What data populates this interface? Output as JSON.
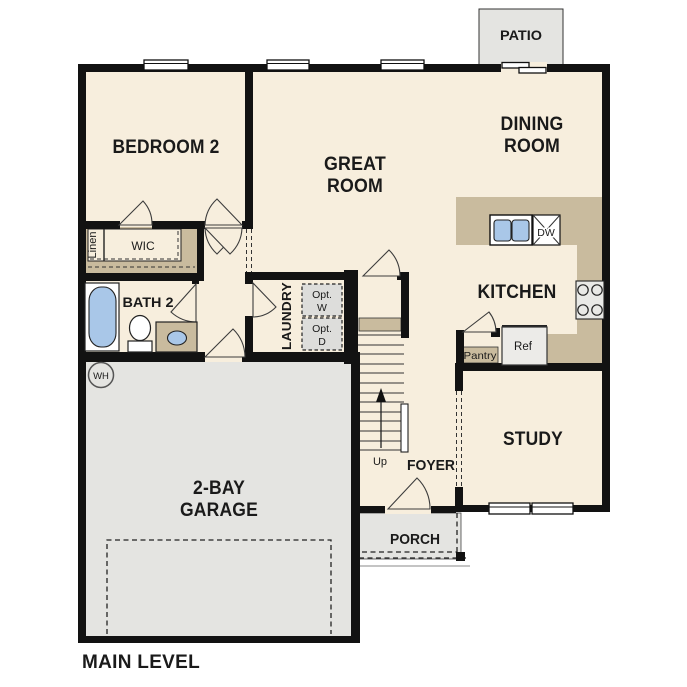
{
  "colors": {
    "floor": "#f7eedd",
    "counter_tan": "#c9bb9e",
    "concrete_gray": "#e4e4e1",
    "appliance_gray": "#dddddb",
    "refrigerator_gray": "#ecebe8",
    "fixture_blue": "#a9c7e8",
    "wall_black": "#121212",
    "text": "#1a1a1a"
  },
  "labels": {
    "patio": "PATIO",
    "dining_room_line1": "DINING",
    "dining_room_line2": "ROOM",
    "great_room_line1": "GREAT",
    "great_room_line2": "ROOM",
    "bedroom2": "BEDROOM 2",
    "wic": "WIC",
    "linen": "Linen",
    "bath2": "BATH 2",
    "laundry": "LAUNDRY",
    "opt_washer_line1": "Opt.",
    "opt_washer_line2": "W",
    "opt_dryer_line1": "Opt.",
    "opt_dryer_line2": "D",
    "kitchen": "KITCHEN",
    "dishwasher": "DW",
    "refrigerator": "Ref",
    "pantry": "Pantry",
    "study": "STUDY",
    "foyer": "FOYER",
    "up": "Up",
    "porch": "PORCH",
    "garage_line1": "2-BAY",
    "garage_line2": "GARAGE",
    "water_heater": "WH",
    "main_level": "MAIN LEVEL"
  }
}
